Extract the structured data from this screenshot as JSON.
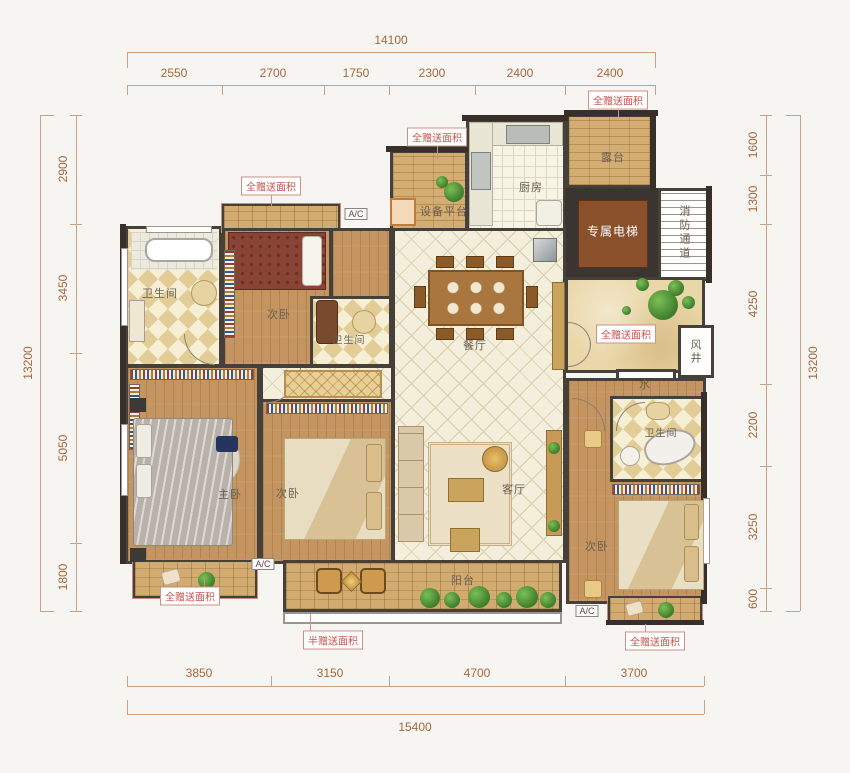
{
  "dims": {
    "top": {
      "total": "14100",
      "segs": [
        "2550",
        "2700",
        "1750",
        "2300",
        "2400",
        "2400"
      ]
    },
    "bottom": {
      "total": "15400",
      "segs": [
        "3850",
        "3150",
        "4700",
        "3700"
      ]
    },
    "left": {
      "total": "13200",
      "segs": [
        "2900",
        "3450",
        "5050",
        "1800"
      ]
    },
    "right": {
      "total": "13200",
      "segs": [
        "1600",
        "1300",
        "4250",
        "2200",
        "3250",
        "600"
      ]
    }
  },
  "rooms": {
    "bath1": "卫生间",
    "bed_top": "次卧",
    "bath2": "卫生间",
    "equipment": "设备平台",
    "kitchen": "厨房",
    "terrace": "露台",
    "elevator": "专属电梯",
    "fire": "消防通道",
    "dining": "餐厅",
    "wind": "风井",
    "water": "水",
    "master": "主卧",
    "bed2": "次卧",
    "living": "客厅",
    "balcony": "阳台",
    "bed3": "次卧",
    "bath3": "卫生间"
  },
  "tags": {
    "gift_full": "全赠送面积",
    "gift_half": "半赠送面积",
    "ac": "A/C"
  },
  "colors": {
    "wall": "#3b3531",
    "wood": "#c49560",
    "tile": "#f4eedc",
    "elevator_brown": "#8a4f2b",
    "gift_red": "#c2574d",
    "dim_text": "#a3683f"
  }
}
